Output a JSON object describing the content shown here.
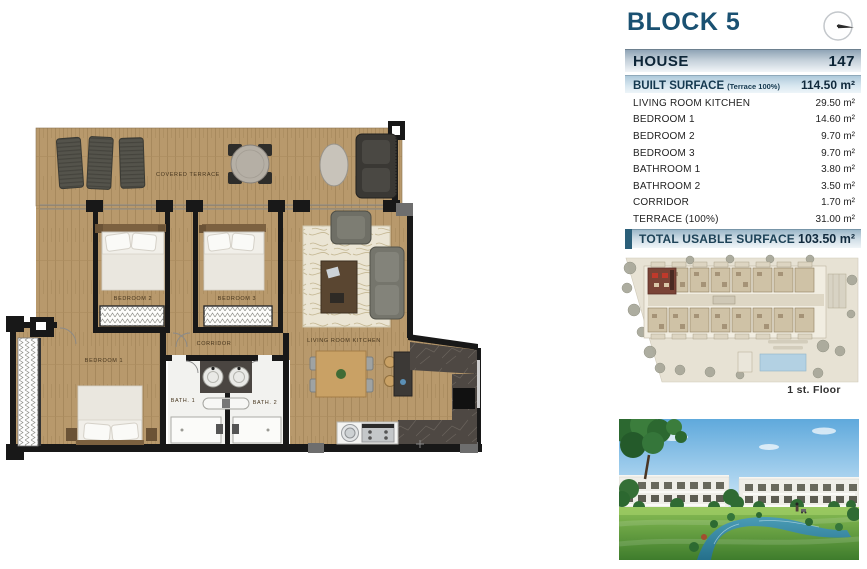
{
  "header": {
    "block_title": "BLOCK 5",
    "house_label": "HOUSE",
    "house_number": "147"
  },
  "surface_table": {
    "built_surface_label": "BUILT SURFACE",
    "built_surface_note": "(Terrace 100%)",
    "built_surface_value": "114.50 m²",
    "rows": [
      {
        "label": "LIVING ROOM KITCHEN",
        "value": "29.50 m²"
      },
      {
        "label": "BEDROOM 1",
        "value": "14.60 m²"
      },
      {
        "label": "BEDROOM 2",
        "value": "9.70 m²"
      },
      {
        "label": "BEDROOM 3",
        "value": "9.70 m²"
      },
      {
        "label": "BATHROOM 1",
        "value": "3.80 m²"
      },
      {
        "label": "BATHROOM 2",
        "value": "3.50 m²"
      },
      {
        "label": "CORRIDOR",
        "value": "1.70 m²"
      },
      {
        "label": "TERRACE (100%)",
        "value": "31.00 m²"
      }
    ],
    "total_label": "TOTAL USABLE SURFACE",
    "total_value": "103.50 m²"
  },
  "floor_plan": {
    "rooms": {
      "covered_terrace": "COVERED TERRACE",
      "bedroom_2": "BEDROOM 2",
      "bedroom_3": "BEDROOM 3",
      "corridor": "CORRIDOR",
      "living_room_kitchen": "LIVING ROOM KITCHEN",
      "bedroom_1": "BEDROOM 1",
      "bath_1": "BATH. 1",
      "bath_2": "BATH. 2"
    }
  },
  "site_plan": {
    "floor_label": "1 st. Floor"
  },
  "colors": {
    "accent_blue": "#1a5172",
    "bar_silver_top": "#8fa4b6",
    "bar_blue_top": "#aecadb",
    "total_block": "#2b5f79",
    "wood": "#b8996c",
    "wall": "#181818",
    "site_beige": "#e7e2d4",
    "unit_tan": "#cfc2a6",
    "highlight_unit": "#7a4336",
    "pool_blue": "#b3d1e3",
    "water": "#2a7a95",
    "lawn": "#5c9a3c",
    "sky": "#5fa9dc"
  }
}
